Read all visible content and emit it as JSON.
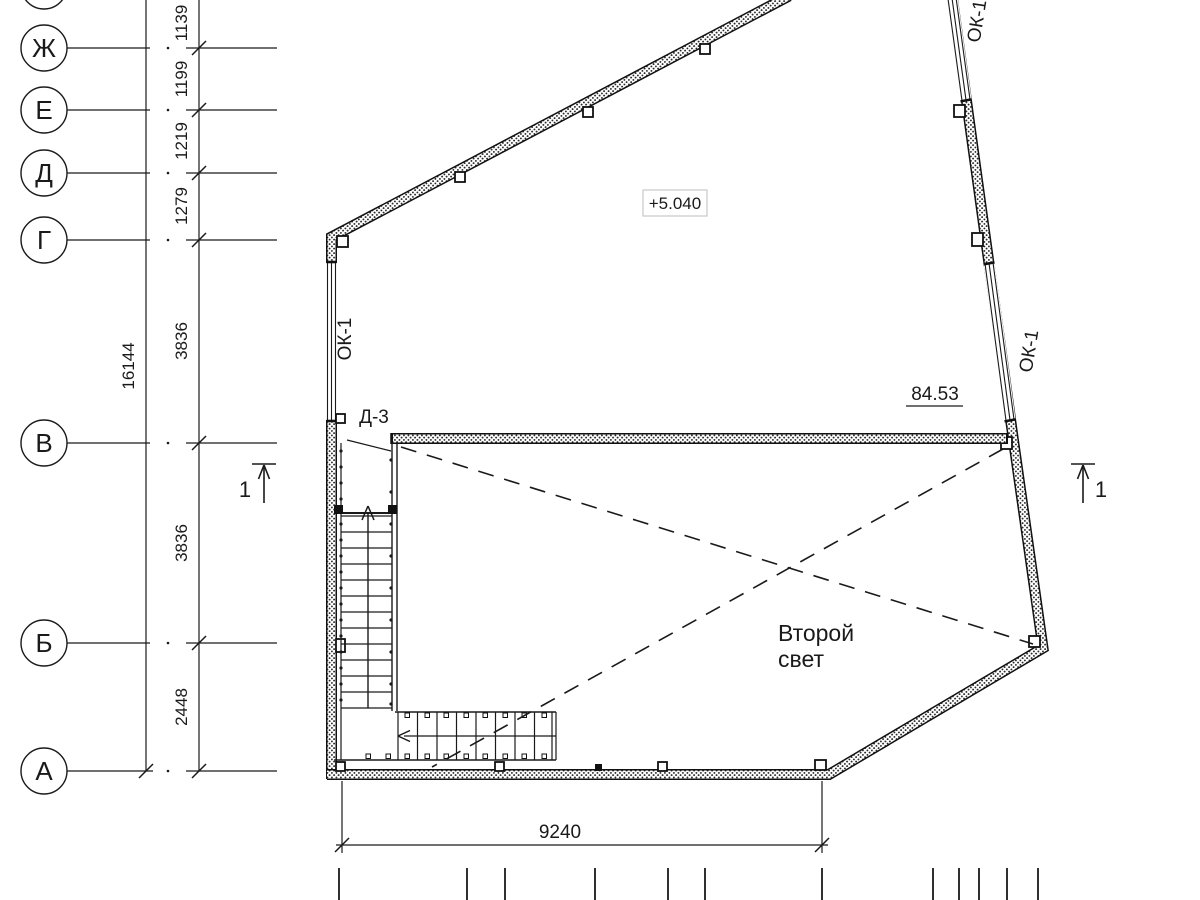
{
  "grid_axes": {
    "labels": [
      "Ж",
      "Е",
      "Д",
      "Г",
      "В",
      "Б",
      "А"
    ]
  },
  "dimensions": {
    "left_segments": [
      "1139",
      "1199",
      "1219",
      "1279",
      "3836",
      "3836",
      "2448"
    ],
    "left_overall": "16144",
    "bottom_width": "9240"
  },
  "marks": {
    "level": "+5.040",
    "elevation": "84.53",
    "door": "Д-3",
    "window_left": "ОК-1",
    "window_right": "ОК-1",
    "window_top": "ОК-1",
    "section_left": "1",
    "section_right": "1"
  },
  "room": {
    "lines": [
      "Второй",
      "свет"
    ]
  },
  "colors": {
    "line": "#1a1a1a",
    "background": "#ffffff",
    "level_box_border": "#c8c8c8"
  }
}
